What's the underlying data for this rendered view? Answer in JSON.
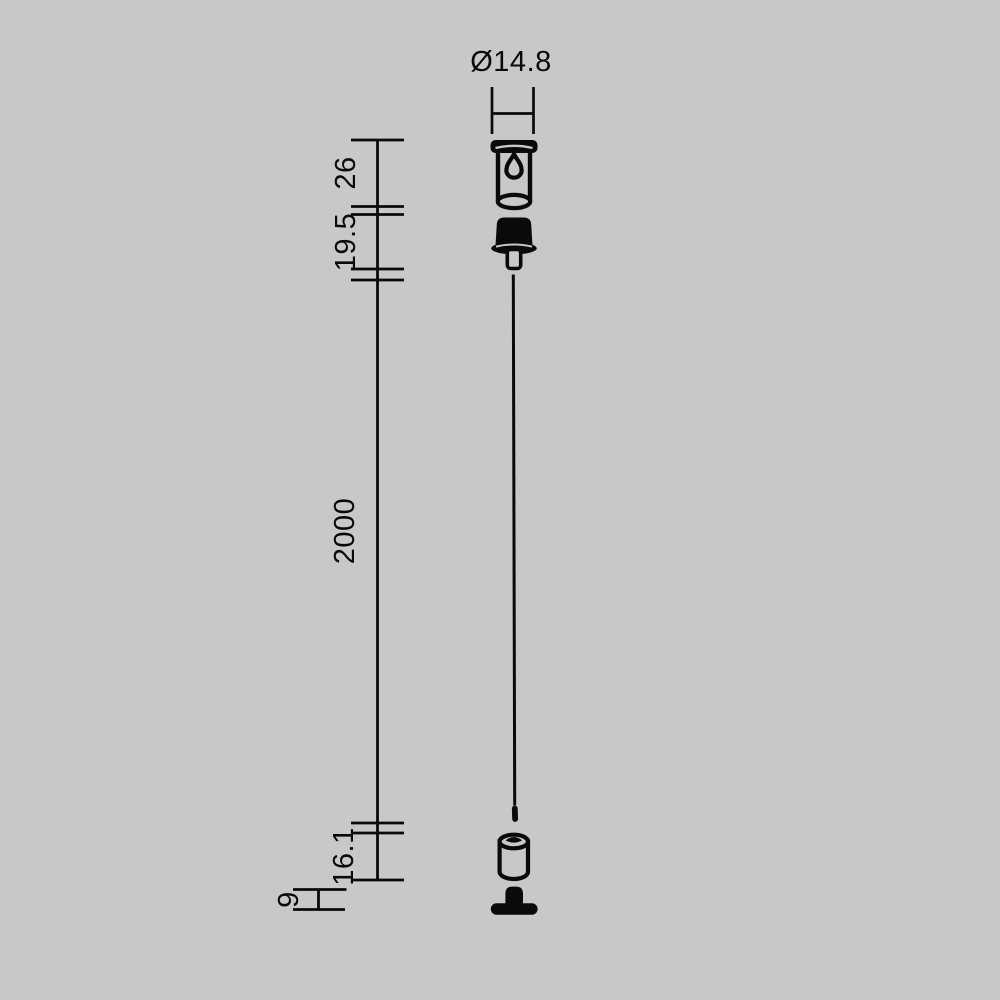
{
  "background_color": "#c8c8c8",
  "line_color": "#0a0a0a",
  "drawing": {
    "kind": "technical-dimension-drawing",
    "parts": [
      "ceiling-fixing-cup-with-keyhole",
      "cable-gripper",
      "suspension-cable",
      "cable-end-holder",
      "fixing-screw-with-flange"
    ]
  },
  "dimensions": {
    "top_diameter": "Ø14.8",
    "canopy_height": "26",
    "gripper_height": "19.5",
    "cable_length": "2000",
    "end_holder_height": "16.1",
    "screw_height": "9"
  }
}
